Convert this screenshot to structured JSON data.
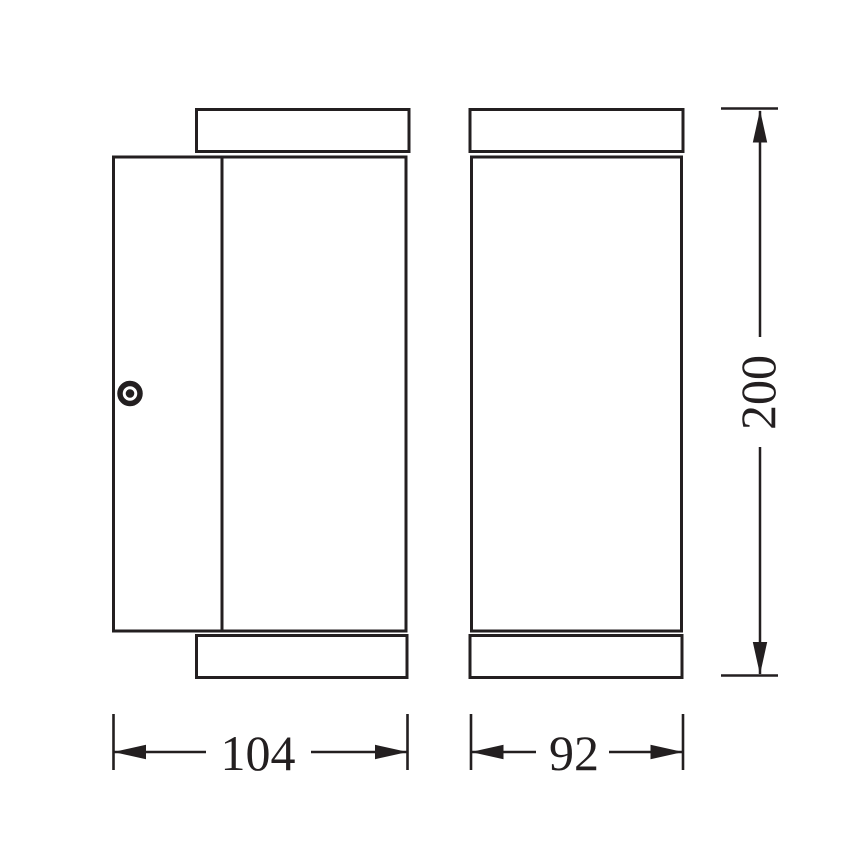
{
  "drawing": {
    "type": "technical-dimension-diagram",
    "subject": "wall-luminaire-two-views",
    "line_color": "#231f20",
    "background_color": "#ffffff",
    "icons": {
      "screw": "concentric-circles"
    },
    "dimensions": {
      "side_view_width": "104",
      "front_view_width": "92",
      "overall_height": "200"
    }
  }
}
